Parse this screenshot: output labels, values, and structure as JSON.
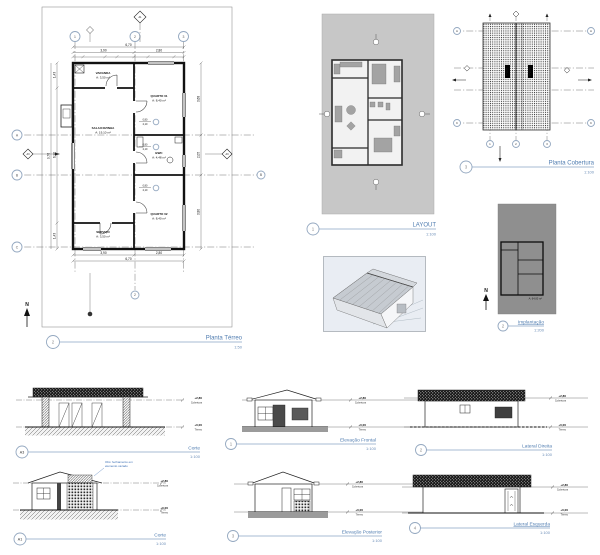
{
  "colors": {
    "title_text": "#4f7cb0",
    "title_line": "#8aa5c4",
    "note_blue": "#3b6fb5",
    "layout_bg": "#c7c7c7",
    "implantacao_bg": "#8f8f8f",
    "persp_bg": "#e9edf3",
    "ink": "#111111"
  },
  "levels": {
    "upper_value": "+2,80",
    "upper_name": "Cobertura",
    "lower_value": "+0,00",
    "lower_name": "Térreo"
  },
  "views": {
    "planta_terreo": {
      "number": "2",
      "title": "Planta Térreo",
      "scale": "1:50",
      "north_label": "N",
      "grid_cols": [
        "1",
        "2",
        "3"
      ],
      "grid_rows": [
        "A",
        "B",
        "C"
      ],
      "section_top": "A1",
      "section_side": "A3",
      "rooms": {
        "varanda": {
          "name": "VARANDA",
          "area": "A: 3,50 m²"
        },
        "quarto1": {
          "name": "QUARTO 01",
          "area": "A: 8,40 m²"
        },
        "sala": {
          "name": "SALA/COZINHA",
          "area": "A: 19,10 m²"
        },
        "bwc": {
          "name": "BWC",
          "area": "A: 4,48 m²"
        },
        "quarto2": {
          "name": "QUARTO 02",
          "area": "A: 8,40 m²"
        },
        "servico": {
          "name": "SERVIÇO",
          "area": "A: 3,50 m²"
        }
      },
      "dims": {
        "top_total": "6,70",
        "top_a": "3,90",
        "top_b": "2,80",
        "bottom_a": "3,90",
        "bottom_b": "2,80",
        "bottom_total": "6,70",
        "left_a": "1,43",
        "left_b": "6,90",
        "left_c": "1,43",
        "left_total": "9,76",
        "right_a": "3,68",
        "right_b": "2,05",
        "right_c": "3,80"
      },
      "door_tag": {
        "w": "0,80",
        "h": "2,10"
      }
    },
    "layout": {
      "number": "1",
      "title": "LAYOUT",
      "scale": "1:100"
    },
    "cobertura": {
      "number": "3",
      "title": "Planta Cobertura",
      "scale": "1:100",
      "slope_tag": "i=10%"
    },
    "implantacao": {
      "number": "2",
      "title": "Implantação",
      "scale": "1:200",
      "north_label": "N",
      "area_label": "A: 64,00 m²"
    },
    "corte_a3": {
      "number": "A3",
      "title": "Corte",
      "scale": "1:100"
    },
    "corte_a1": {
      "number": "A1",
      "title": "Corte",
      "scale": "1:100",
      "note_line1": "Obs: fechamento em",
      "note_line2": "elemento vazado"
    },
    "elev_frontal": {
      "number": "1",
      "title": "Elevação Frontal",
      "scale": "1:100"
    },
    "lateral_direita": {
      "number": "2",
      "title": "Lateral Direita",
      "scale": "1:100"
    },
    "elev_posterior": {
      "number": "3",
      "title": "Elevação Posterior",
      "scale": "1:100"
    },
    "lateral_esquerda": {
      "number": "4",
      "title": "Lateral Esquerda",
      "scale": "1:100"
    }
  }
}
